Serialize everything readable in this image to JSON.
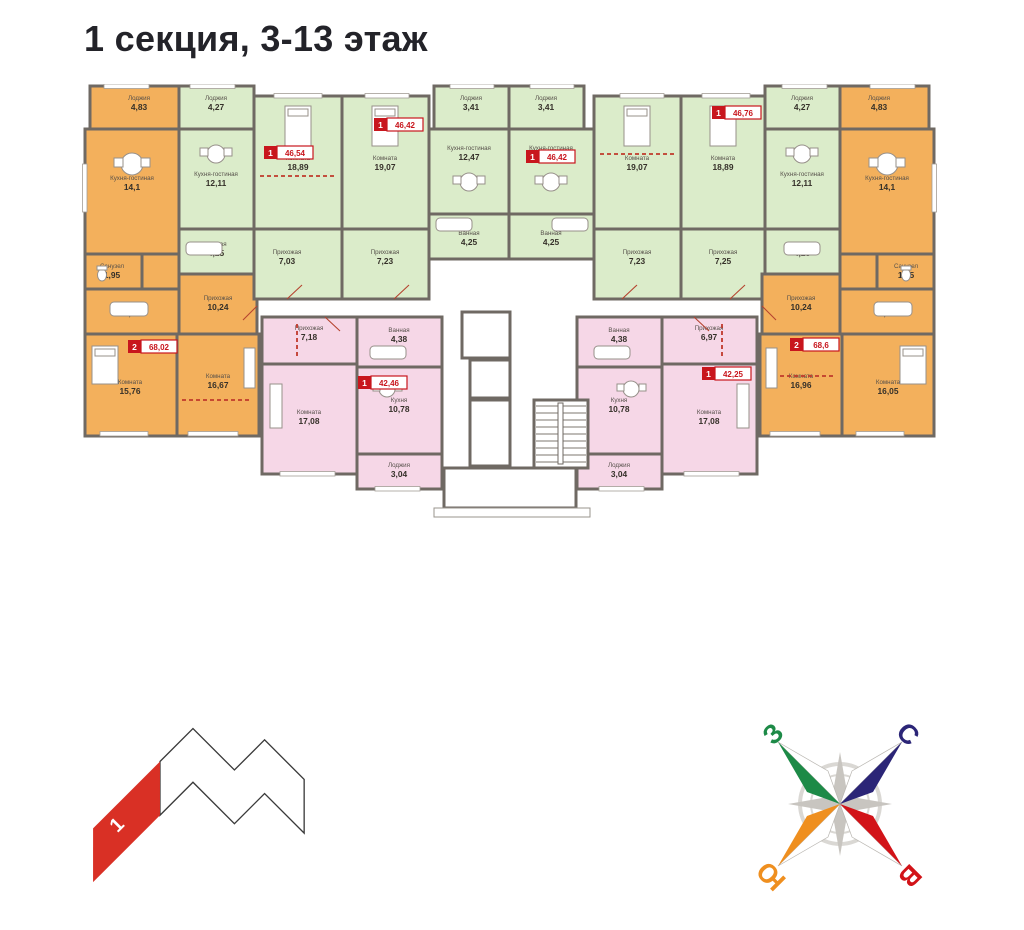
{
  "title": "1 секция, 3-13 этаж",
  "colors": {
    "orange": "#F3B05C",
    "green": "#DBECCA",
    "pink": "#F6D7E7",
    "wall": "#6F6963",
    "badge": "#C8161D",
    "dash": "#C0392B",
    "minimap_red": "#D93025",
    "compass_north": "#2B2577",
    "compass_west": "#1D8A47",
    "compass_south": "#EF8F1F",
    "compass_east": "#D21318"
  },
  "rooms": [
    {
      "name": "Лоджия",
      "area": "4,83"
    },
    {
      "name": "Кухня-гостиная",
      "area": "14,1"
    },
    {
      "name": "Санузел",
      "area": "1,95"
    },
    {
      "name": "Ванная",
      "area": "4,48"
    },
    {
      "name": "Прихожая",
      "area": "10,24"
    },
    {
      "name": "Комната",
      "area": "15,76"
    },
    {
      "name": "Комната",
      "area": "16,67"
    },
    {
      "name": "Лоджия",
      "area": "4,27"
    },
    {
      "name": "Кухня-гостиная",
      "area": "12,11"
    },
    {
      "name": "Ванная",
      "area": "4,25"
    },
    {
      "name": "Комната",
      "area": "18,89"
    },
    {
      "name": "Прихожая",
      "area": "7,03"
    },
    {
      "name": "Комната",
      "area": "19,07"
    },
    {
      "name": "Прихожая",
      "area": "7,23"
    },
    {
      "name": "Кухня-гостиная",
      "area": "12,47"
    },
    {
      "name": "Лоджия",
      "area": "3,41"
    },
    {
      "name": "Ванная",
      "area": "4,25"
    },
    {
      "name": "Лоджия",
      "area": "3,41"
    },
    {
      "name": "Кухня-гостиная",
      "area": "12,47"
    },
    {
      "name": "Ванная",
      "area": "4,25"
    },
    {
      "name": "Комната",
      "area": "19,07"
    },
    {
      "name": "Прихожая",
      "area": "7,23"
    },
    {
      "name": "Комната",
      "area": "18,89"
    },
    {
      "name": "Прихожая",
      "area": "7,25"
    },
    {
      "name": "Кухня-гостиная",
      "area": "12,11"
    },
    {
      "name": "Лоджия",
      "area": "4,27"
    },
    {
      "name": "Ванная",
      "area": "4,25"
    },
    {
      "name": "Лоджия",
      "area": "4,83"
    },
    {
      "name": "Кухня-гостиная",
      "area": "14,1"
    },
    {
      "name": "Санузел",
      "area": "1,95"
    },
    {
      "name": "Ванная",
      "area": "4,48"
    },
    {
      "name": "Прихожая",
      "area": "10,24"
    },
    {
      "name": "Комната",
      "area": "16,05"
    },
    {
      "name": "Комната",
      "area": "16,96"
    },
    {
      "name": "Прихожая",
      "area": "7,18"
    },
    {
      "name": "Ванная",
      "area": "4,38"
    },
    {
      "name": "Кухня",
      "area": "10,78"
    },
    {
      "name": "Комната",
      "area": "17,08"
    },
    {
      "name": "Лоджия",
      "area": "3,04"
    },
    {
      "name": "Ванная",
      "area": "4,38"
    },
    {
      "name": "Прихожая",
      "area": "6,97"
    },
    {
      "name": "Кухня",
      "area": "10,78"
    },
    {
      "name": "Комната",
      "area": "17,08"
    },
    {
      "name": "Лоджия",
      "area": "3,04"
    }
  ],
  "badges": [
    {
      "rooms": "1",
      "area": "46,54"
    },
    {
      "rooms": "1",
      "area": "46,42"
    },
    {
      "rooms": "1",
      "area": "46,42"
    },
    {
      "rooms": "1",
      "area": "46,76"
    },
    {
      "rooms": "2",
      "area": "68,02"
    },
    {
      "rooms": "2",
      "area": "68,6"
    },
    {
      "rooms": "1",
      "area": "42,46"
    },
    {
      "rooms": "1",
      "area": "42,25"
    }
  ],
  "compass": {
    "north": "С",
    "west": "З",
    "south": "Ю",
    "east": "В"
  },
  "minimap": {
    "section_label": "1"
  }
}
